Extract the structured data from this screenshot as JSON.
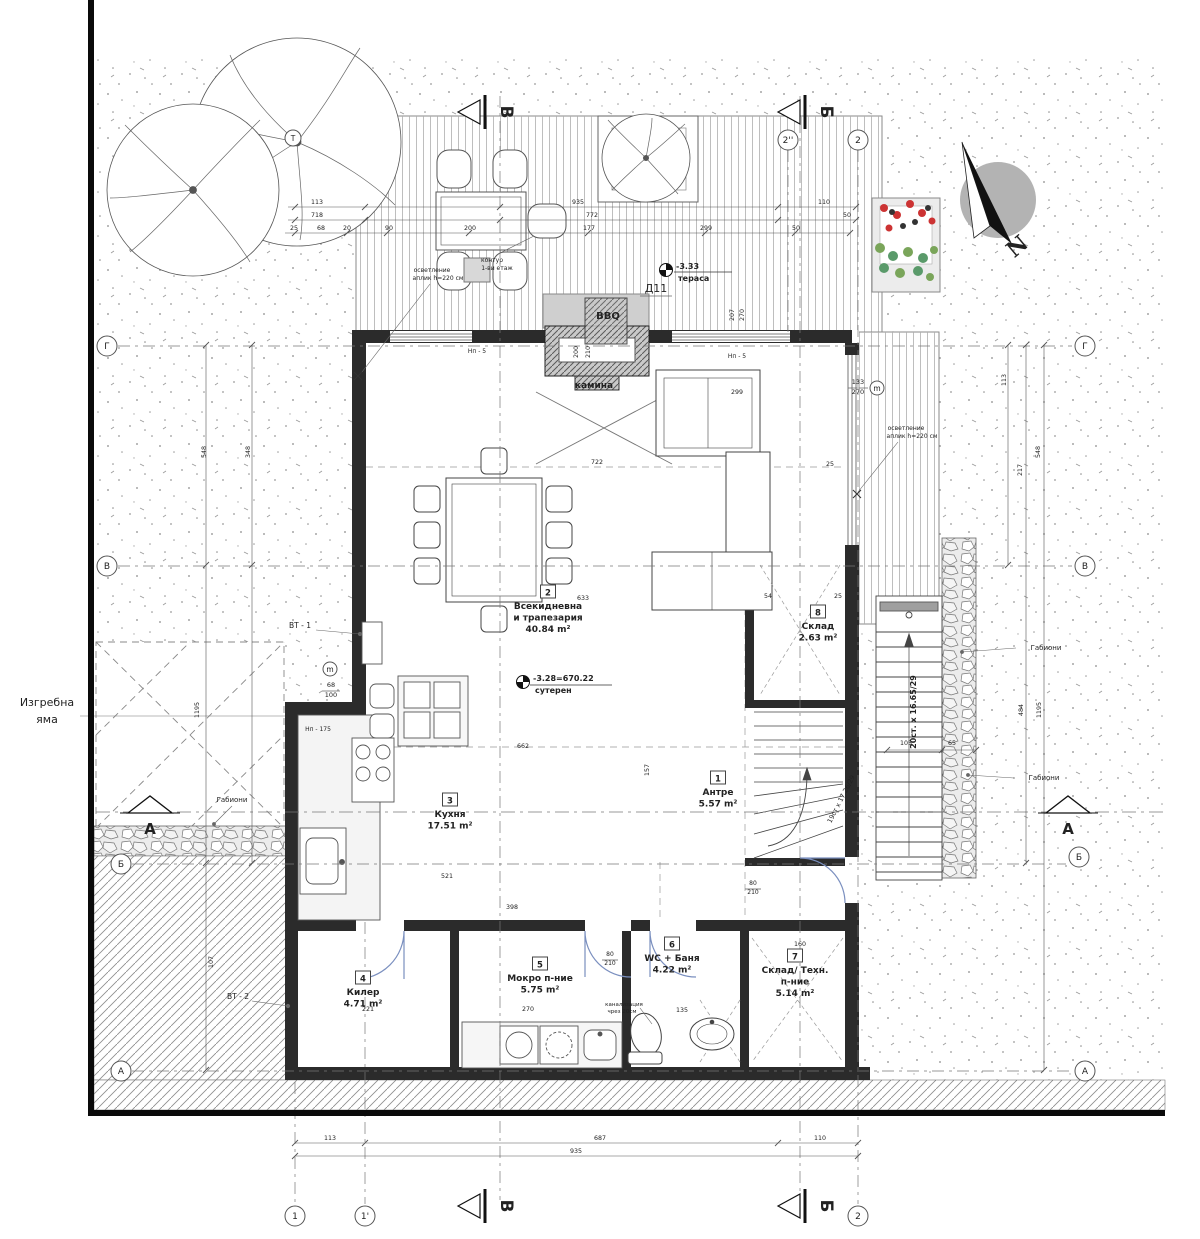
{
  "compass": {
    "n": "N"
  },
  "rooms": [
    {
      "num": "1",
      "lines": [
        "Антре"
      ],
      "area": "5.57 m²",
      "x": 718,
      "y": 778
    },
    {
      "num": "2",
      "lines": [
        "Всекидневна",
        "и трапезария"
      ],
      "area": "40.84 m²",
      "x": 548,
      "y": 592
    },
    {
      "num": "3",
      "lines": [
        "Кухня"
      ],
      "area": "17.51 m²",
      "x": 450,
      "y": 800
    },
    {
      "num": "4",
      "lines": [
        "Килер"
      ],
      "area": "4.71 m²",
      "x": 363,
      "y": 978
    },
    {
      "num": "5",
      "lines": [
        "Мокро п-ние"
      ],
      "area": "5.75 m²",
      "x": 540,
      "y": 964
    },
    {
      "num": "6",
      "lines": [
        "WC + Баня"
      ],
      "area": "4.22 m²",
      "x": 672,
      "y": 944
    },
    {
      "num": "7",
      "lines": [
        "Склад/ Техн.",
        "п-ние"
      ],
      "area": "5.14 m²",
      "x": 795,
      "y": 956
    },
    {
      "num": "8",
      "lines": [
        "Склад"
      ],
      "area": "2.63 m²",
      "x": 818,
      "y": 612
    }
  ],
  "levels": [
    {
      "value": "-3.33",
      "name": "тераса",
      "x": 666,
      "y": 270
    },
    {
      "value": "-3.28=670.22",
      "name": "сутерен",
      "x": 523,
      "y": 682
    }
  ],
  "notes": [
    {
      "t": "Изгребна",
      "x": 47,
      "y": 706,
      "s": 11
    },
    {
      "t": "яма",
      "x": 47,
      "y": 723,
      "s": 11
    },
    {
      "t": "камина",
      "x": 594,
      "y": 388,
      "s": 9,
      "b": 1
    },
    {
      "t": "BBQ",
      "x": 608,
      "y": 319,
      "s": 10,
      "b": 1
    },
    {
      "t": "Д11",
      "x": 656,
      "y": 292,
      "s": 11
    },
    {
      "t": "контур",
      "x": 492,
      "y": 262,
      "s": 6
    },
    {
      "t": "1-ви етаж",
      "x": 497,
      "y": 270,
      "s": 6
    },
    {
      "t": "осветление",
      "x": 432,
      "y": 272,
      "s": 6
    },
    {
      "t": "аплик h=220 см",
      "x": 438,
      "y": 280,
      "s": 6
    },
    {
      "t": "осветление",
      "x": 906,
      "y": 430,
      "s": 6
    },
    {
      "t": "аплик h=220 см",
      "x": 912,
      "y": 438,
      "s": 6
    },
    {
      "t": "Габиони",
      "x": 232,
      "y": 802,
      "s": 7
    },
    {
      "t": "Габиони",
      "x": 1046,
      "y": 650,
      "s": 7
    },
    {
      "t": "Габиони",
      "x": 1044,
      "y": 780,
      "s": 7
    },
    {
      "t": "ВТ - 1",
      "x": 300,
      "y": 628,
      "s": 7.5
    },
    {
      "t": "ВТ - 2",
      "x": 238,
      "y": 999,
      "s": 7.5
    },
    {
      "t": "20ст. x 16.65/29",
      "x": 916,
      "y": 712,
      "s": 8,
      "b": 1,
      "r": -90
    },
    {
      "t": "19ст x 17.26/29",
      "x": 843,
      "y": 800,
      "s": 6.5,
      "r": -63
    },
    {
      "t": "Нп - 5",
      "x": 477,
      "y": 353,
      "s": 6
    },
    {
      "t": "Нп - 5",
      "x": 737,
      "y": 358,
      "s": 6
    },
    {
      "t": "Нп - 175",
      "x": 318,
      "y": 731,
      "s": 6
    },
    {
      "t": "канализация",
      "x": 624,
      "y": 1006,
      "s": 5.5
    },
    {
      "t": "чрез 20см",
      "x": 622,
      "y": 1013,
      "s": 5.5
    },
    {
      "t": "133",
      "x": 858,
      "y": 384,
      "s": 6.5
    },
    {
      "t": "270",
      "x": 858,
      "y": 394,
      "s": 6.5
    },
    {
      "t": "68",
      "x": 331,
      "y": 687,
      "s": 6.5
    },
    {
      "t": "100",
      "x": 331,
      "y": 697,
      "s": 6.5
    },
    {
      "t": "80",
      "x": 753,
      "y": 885,
      "s": 6
    },
    {
      "t": "210",
      "x": 753,
      "y": 894,
      "s": 6
    },
    {
      "t": "80",
      "x": 610,
      "y": 956,
      "s": 6
    },
    {
      "t": "210",
      "x": 610,
      "y": 965,
      "s": 6
    }
  ],
  "dims": [
    {
      "t": "113",
      "x": 317,
      "y": 204
    },
    {
      "t": "935",
      "x": 578,
      "y": 204
    },
    {
      "t": "110",
      "x": 824,
      "y": 204
    },
    {
      "t": "718",
      "x": 317,
      "y": 217
    },
    {
      "t": "772",
      "x": 592,
      "y": 217
    },
    {
      "t": "50",
      "x": 847,
      "y": 217
    },
    {
      "t": "25",
      "x": 294,
      "y": 230
    },
    {
      "t": "68",
      "x": 321,
      "y": 230
    },
    {
      "t": "20",
      "x": 347,
      "y": 230
    },
    {
      "t": "90",
      "x": 389,
      "y": 230
    },
    {
      "t": "200",
      "x": 470,
      "y": 230
    },
    {
      "t": "177",
      "x": 589,
      "y": 230
    },
    {
      "t": "299",
      "x": 706,
      "y": 230
    },
    {
      "t": "50",
      "x": 796,
      "y": 230
    },
    {
      "t": "200",
      "x": 578,
      "y": 352,
      "r": -90
    },
    {
      "t": "210",
      "x": 590,
      "y": 352,
      "r": -90
    },
    {
      "t": "207",
      "x": 734,
      "y": 315,
      "r": -90
    },
    {
      "t": "270",
      "x": 744,
      "y": 315,
      "r": -90
    },
    {
      "t": "299",
      "x": 737,
      "y": 394
    },
    {
      "t": "25",
      "x": 830,
      "y": 466
    },
    {
      "t": "113",
      "x": 330,
      "y": 1140
    },
    {
      "t": "687",
      "x": 600,
      "y": 1140
    },
    {
      "t": "110",
      "x": 820,
      "y": 1140
    },
    {
      "t": "935",
      "x": 576,
      "y": 1153
    },
    {
      "t": "348",
      "x": 250,
      "y": 452,
      "r": -90
    },
    {
      "t": "548",
      "x": 206,
      "y": 452,
      "r": -90
    },
    {
      "t": "1195",
      "x": 199,
      "y": 710,
      "r": -90
    },
    {
      "t": "107",
      "x": 213,
      "y": 962,
      "r": -90
    },
    {
      "t": "113",
      "x": 1006,
      "y": 380,
      "r": -90
    },
    {
      "t": "217",
      "x": 1022,
      "y": 470,
      "r": -90
    },
    {
      "t": "548",
      "x": 1040,
      "y": 452,
      "r": -90
    },
    {
      "t": "484",
      "x": 1023,
      "y": 710,
      "r": -90
    },
    {
      "t": "1195",
      "x": 1041,
      "y": 710,
      "r": -90
    },
    {
      "t": "105",
      "x": 906,
      "y": 745
    },
    {
      "t": "65",
      "x": 952,
      "y": 745
    },
    {
      "t": "722",
      "x": 597,
      "y": 464
    },
    {
      "t": "633",
      "x": 583,
      "y": 600
    },
    {
      "t": "662",
      "x": 523,
      "y": 748
    },
    {
      "t": "521",
      "x": 447,
      "y": 878
    },
    {
      "t": "398",
      "x": 512,
      "y": 909
    },
    {
      "t": "270",
      "x": 528,
      "y": 1011
    },
    {
      "t": "221",
      "x": 368,
      "y": 1011
    },
    {
      "t": "160",
      "x": 800,
      "y": 946
    },
    {
      "t": "135",
      "x": 682,
      "y": 1012
    },
    {
      "t": "157",
      "x": 649,
      "y": 770,
      "r": -90
    },
    {
      "t": "54",
      "x": 768,
      "y": 598
    },
    {
      "t": "25",
      "x": 838,
      "y": 598
    }
  ],
  "grid_bubbles": [
    {
      "l": "Г",
      "x": 107,
      "y": 346
    },
    {
      "l": "В",
      "x": 107,
      "y": 566
    },
    {
      "l": "Б",
      "x": 121,
      "y": 864
    },
    {
      "l": "А",
      "x": 121,
      "y": 1071
    },
    {
      "l": "Г",
      "x": 1085,
      "y": 346
    },
    {
      "l": "В",
      "x": 1085,
      "y": 566
    },
    {
      "l": "Б",
      "x": 1079,
      "y": 857
    },
    {
      "l": "А",
      "x": 1085,
      "y": 1071
    },
    {
      "l": "2''",
      "x": 788,
      "y": 140
    },
    {
      "l": "2",
      "x": 858,
      "y": 140
    },
    {
      "l": "1",
      "x": 295,
      "y": 1216
    },
    {
      "l": "1'",
      "x": 365,
      "y": 1216
    },
    {
      "l": "2",
      "x": 858,
      "y": 1216
    },
    {
      "l": "m",
      "x": 877,
      "y": 388,
      "rr": 7
    },
    {
      "l": "m",
      "x": 330,
      "y": 669,
      "rr": 7
    },
    {
      "l": "Т",
      "x": 293,
      "y": 138,
      "rr": 8
    }
  ],
  "section_markers": [
    {
      "l": "В",
      "x": 478,
      "y": 112,
      "kind": "flag"
    },
    {
      "l": "Б",
      "x": 798,
      "y": 112,
      "kind": "flag"
    },
    {
      "l": "В",
      "x": 478,
      "y": 1206,
      "kind": "flag"
    },
    {
      "l": "Б",
      "x": 798,
      "y": 1206,
      "kind": "flag"
    },
    {
      "l": "А",
      "x": 150,
      "y": 810,
      "kind": "slope"
    },
    {
      "l": "А",
      "x": 1068,
      "y": 810,
      "kind": "slope"
    }
  ]
}
